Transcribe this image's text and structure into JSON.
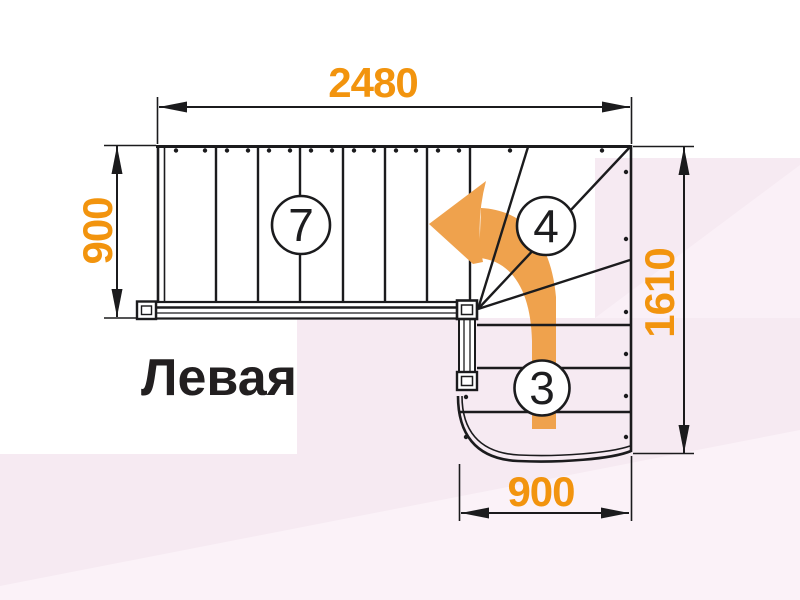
{
  "diagram": {
    "type": "staircase-plan-top-view",
    "label": "Левая",
    "dimensions": {
      "top_width": "2480",
      "left_depth": "900",
      "right_height": "1610",
      "bottom_width": "900"
    },
    "step_counts": {
      "upper_flight": "7",
      "winder_treads": "4",
      "lower_flight": "3"
    },
    "colors": {
      "dimension_orange": "#F2940E",
      "direction_arrow_orange": "#EFA24D",
      "drawing_line": "#1b1b1d",
      "background_pink": "#F6EAF2",
      "background_pink_light": "#FBF2F8",
      "background_white": "#FFFFFF"
    }
  }
}
